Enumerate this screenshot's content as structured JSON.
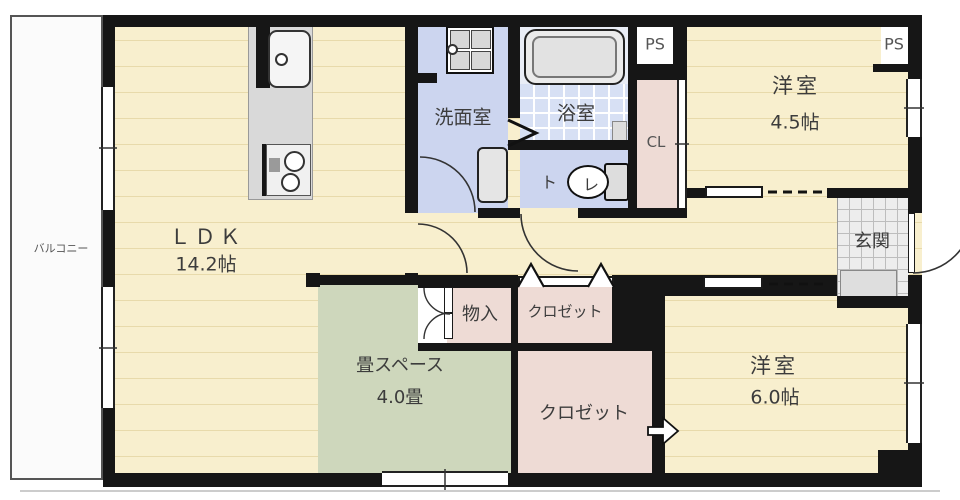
{
  "plan_title": "apartment-floor-plan",
  "rooms": {
    "balcony": "バルコニー",
    "ldk": "ＬＤＫ",
    "ldk_size": "14.2帖",
    "washroom": "洗面室",
    "bathroom": "浴室",
    "toilet_char1": "ト",
    "toilet_char2": "レ",
    "ps_top": "PS",
    "ps_right": "PS",
    "cl": "CL",
    "western1": "洋室",
    "western1_size": "4.5帖",
    "entrance": "玄関",
    "storage": "物入",
    "closet_upper": "クロゼット",
    "closet_lower": "クロゼット",
    "tatami": "畳スペース",
    "tatami_size": "4.0畳",
    "western2": "洋室",
    "western2_size": "6.0帖"
  },
  "colors": {
    "wall": "#161616",
    "floor": "#f8efce",
    "stripe": "#e8daab",
    "tatami": "#ced7bc",
    "closet": "#eedbd5",
    "wet": "#ccd5ef",
    "bathtile": "#d7e0f4",
    "bathupper": "#e9edf6",
    "tile": "#ededed",
    "counter": "#d9d9d9"
  }
}
